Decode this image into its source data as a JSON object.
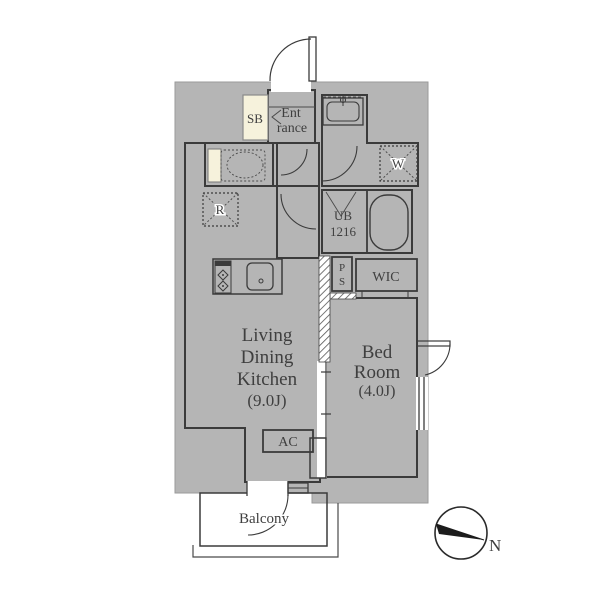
{
  "title": "apartment-floor-plan",
  "rooms": {
    "entrance": {
      "line1": "Ent",
      "line2": "rance"
    },
    "shoe_box": {
      "label": "SB"
    },
    "living_dining_kitchen": {
      "line1": "Living",
      "line2": "Dining",
      "line3": "Kitchen",
      "line4": "(9.0J)"
    },
    "bedroom": {
      "line1": "Bed",
      "line2": "Room",
      "line3": "(4.0J)"
    },
    "unit_bath": {
      "line1": "UB",
      "line2": "1216"
    },
    "walk_in_closet": {
      "label": "WIC"
    },
    "pipe_shaft": {
      "line1": "P",
      "line2": "S"
    },
    "air_conditioner": {
      "label": "AC"
    },
    "washer_space": {
      "label": "W"
    },
    "refrigerator_space": {
      "label": "R"
    },
    "balcony": {
      "label": "Balcony"
    }
  },
  "compass": {
    "north_label": "N"
  },
  "colors": {
    "wall_gray": "#b5b5b5",
    "accent_cream": "#f6f2dc",
    "line_dark": "#3b3b3b",
    "text": "#3f3f3f"
  }
}
